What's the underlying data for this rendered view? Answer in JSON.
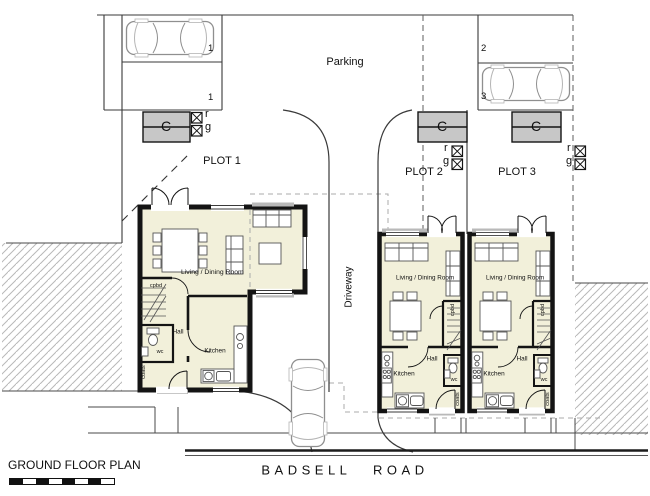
{
  "titles": {
    "plan": "GROUND FLOOR PLAN",
    "road": "BADSELL ROAD"
  },
  "parking": {
    "label": "Parking",
    "bays": {
      "plot1_a": "1",
      "plot1_b": "1",
      "plot2": "2",
      "plot3": "3"
    }
  },
  "driveway": {
    "label": "Driveway"
  },
  "stores": {
    "cycle_label": "C",
    "refuse_label": "r",
    "garden_label": "g"
  },
  "plots": {
    "p1": {
      "label": "PLOT 1",
      "rooms": {
        "living": "Living / Dining Room",
        "hall": "Hall",
        "kitchen": "Kitchen",
        "wc": "wc",
        "cupboard": "cpbd",
        "coats": "coats"
      }
    },
    "p2": {
      "label": "PLOT 2",
      "rooms": {
        "living": "Living / Dining Room",
        "hall": "Hall",
        "kitchen": "Kitchen",
        "wc": "wc",
        "cupboard": "cpbd",
        "coats": "coats"
      }
    },
    "p3": {
      "label": "PLOT 3",
      "rooms": {
        "living": "Living / Dining Room",
        "hall": "Hall",
        "kitchen": "Kitchen",
        "wc": "wc",
        "cupboard": "cpbd",
        "coats": "coats"
      }
    }
  },
  "colors": {
    "house_fill": "#f2f0da",
    "store_fill": "#c7c7c7",
    "porch_gray": "#b9b9b9"
  }
}
